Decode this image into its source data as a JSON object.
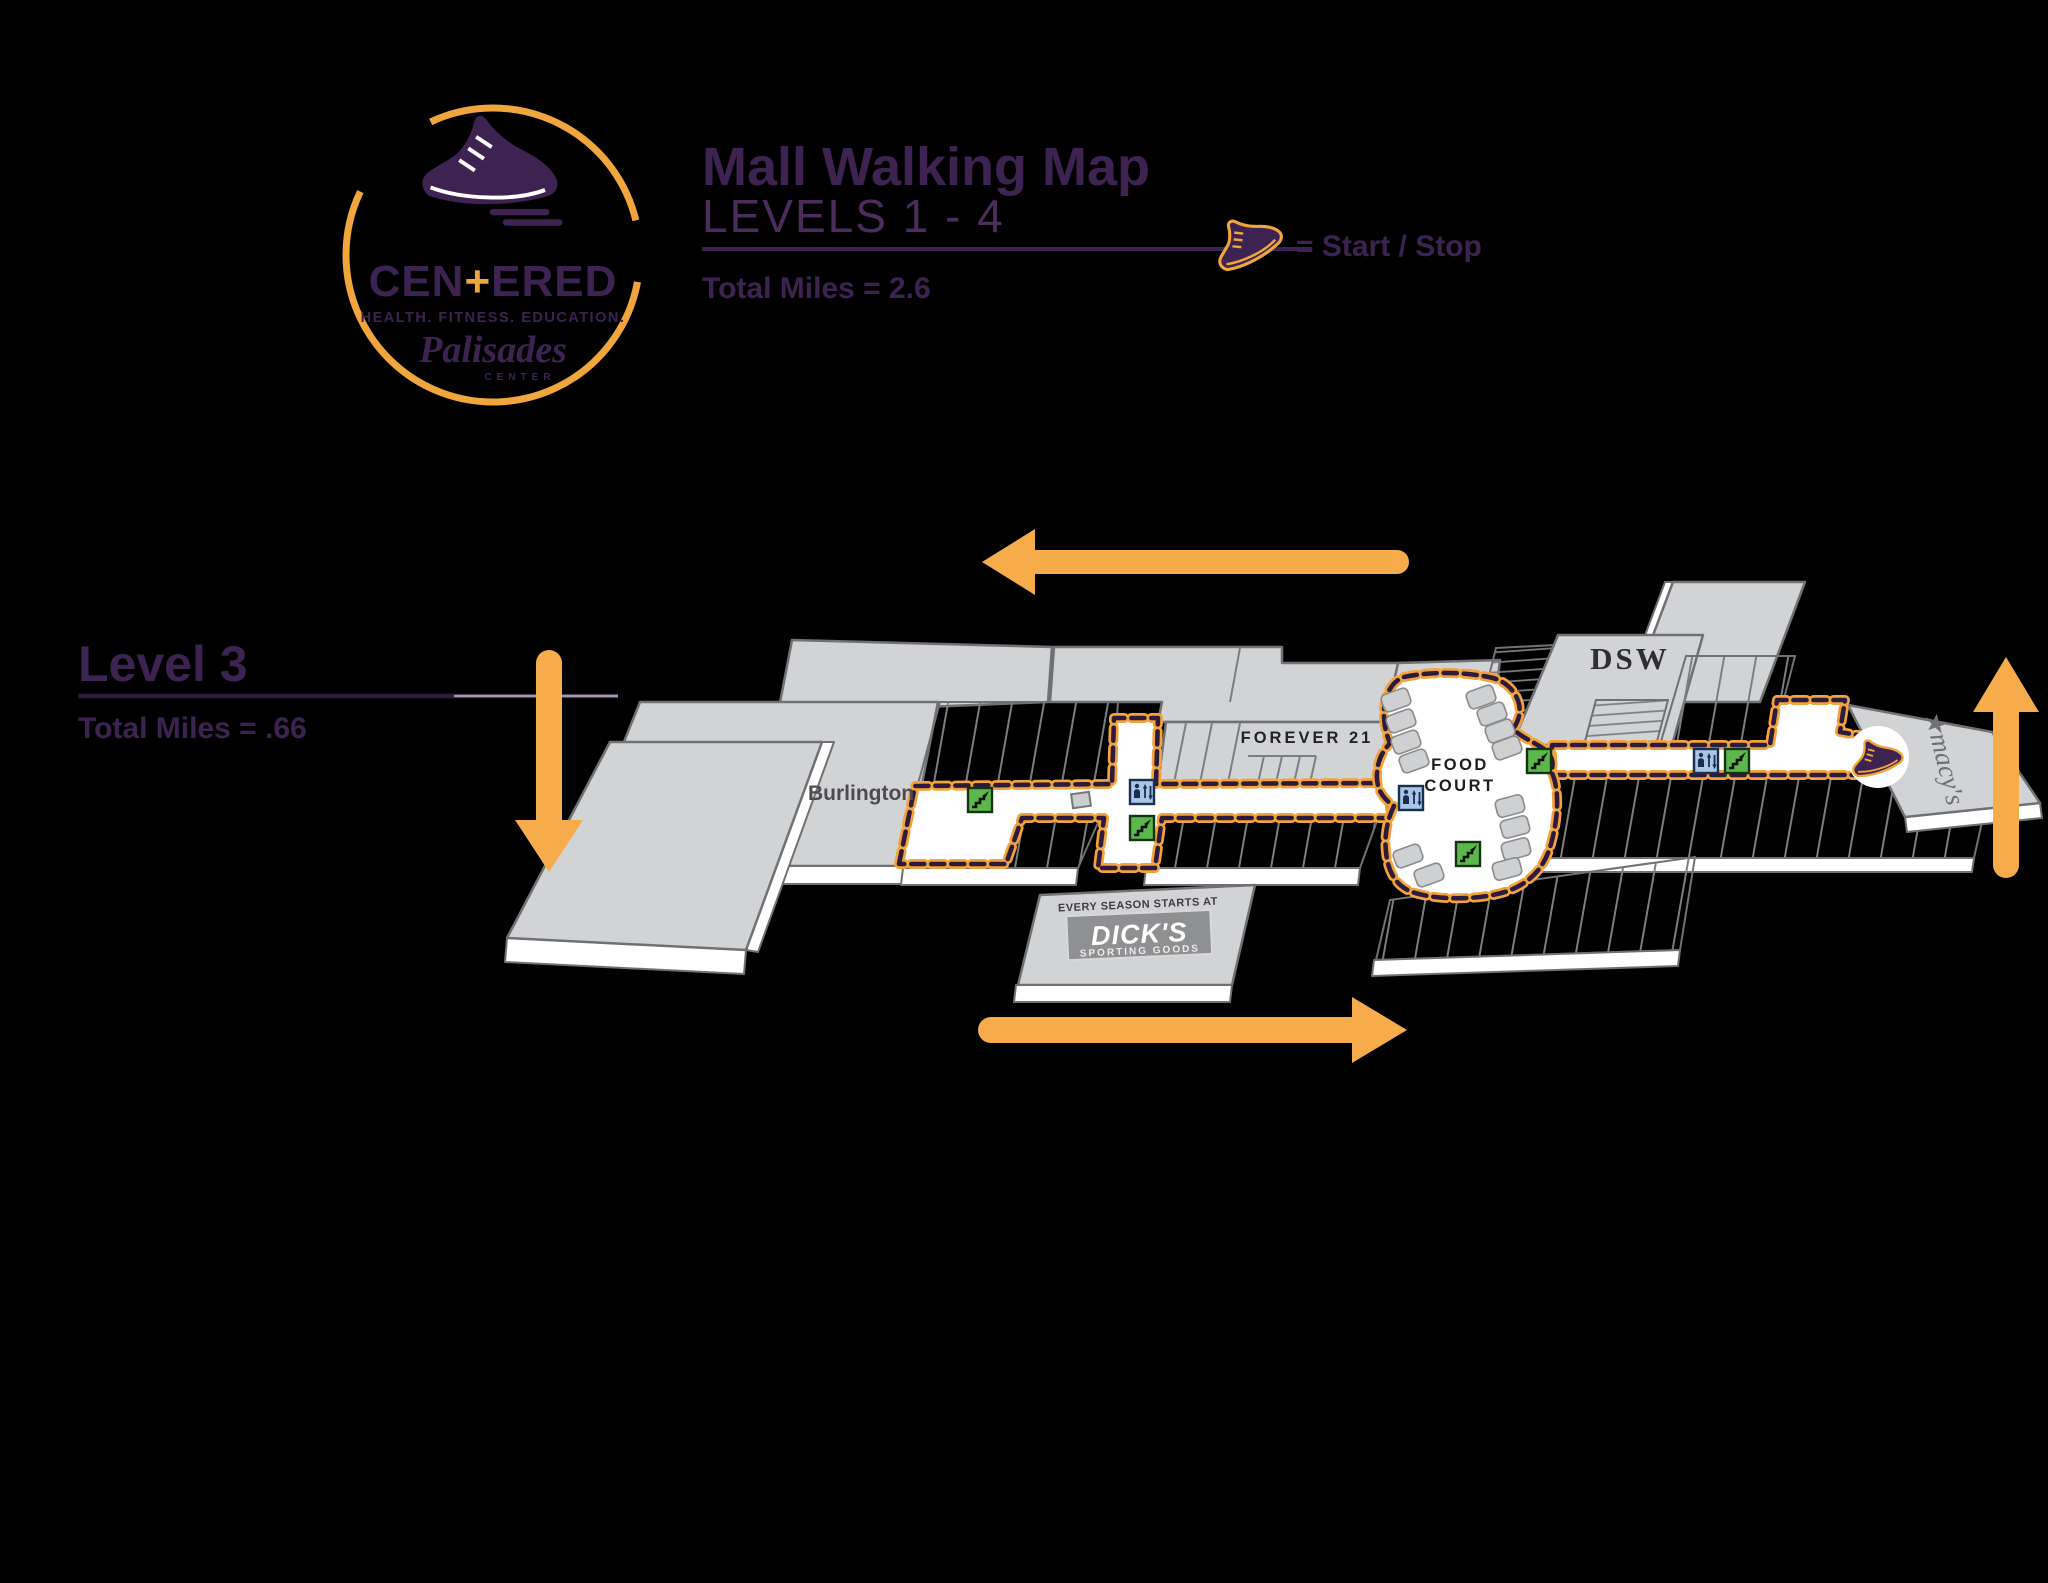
{
  "logo": {
    "brand_pre": "CEN",
    "brand_plus": "+",
    "brand_post": "ERED",
    "tagline": "HEALTH. FITNESS. EDUCATION.",
    "venue": "Palisades",
    "venue_sub": "CENTER"
  },
  "header": {
    "title": "Mall Walking Map",
    "subtitle": "LEVELS 1 - 4",
    "total_miles": "Total Miles = 2.6",
    "legend_label": "= Start / Stop"
  },
  "level": {
    "name": "Level 3",
    "total_miles": "Total Miles = .66"
  },
  "map": {
    "stores": {
      "burlington": "Burlington",
      "forever21": "FOREVER 21",
      "food_court_line1": "FOOD",
      "food_court_line2": "COURT",
      "dsw": "DSW",
      "macys": "★macy's",
      "dicks_tagline": "EVERY SEASON STARTS AT",
      "dicks_name": "DICK'S",
      "dicks_subtitle": "SPORTING GOODS"
    },
    "legend": {
      "escalator_icon": "escalator",
      "elevator_icon": "elevator",
      "start_stop_icon": "sneaker start/stop marker",
      "route_style": "orange dashed walking route"
    },
    "arrows": {
      "top": "left",
      "left_side": "down",
      "bottom": "right",
      "right_side": "up"
    },
    "counts": {
      "escalators": 5,
      "elevators": 3
    },
    "colors": {
      "accent_orange": "#F2A43B",
      "route_dash_purple": "#2E1A3C",
      "plate_gray": "#D2D3D5",
      "plate_outline": "#707174",
      "escalator_green": "#5CB84A",
      "elevator_blue": "#A9C5EA",
      "brand_purple": "#3D2352",
      "background": "#000000"
    }
  }
}
